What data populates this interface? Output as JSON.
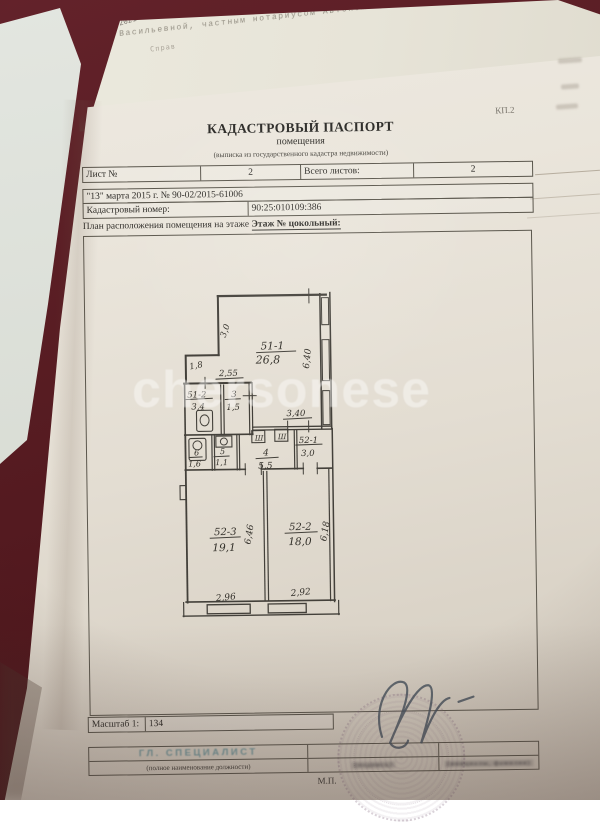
{
  "photo": {
    "watermark": "chersonese",
    "underlying": {
      "date_stamp": "23.03.2021",
      "line1": "августа 199  года».",
      "line2": "настоящий договор     удостоверен     мной,",
      "line3": "Васильевной, частным нотариусом  Автономной Республики",
      "fragment": "Справ"
    }
  },
  "document": {
    "form_code": "КП.2",
    "title": "КАДАСТРОВЫЙ ПАСПОРТ",
    "subtitle": "помещения",
    "subnote": "(выписка из государственного кадастра недвижимости)",
    "sheet": {
      "label": "Лист №",
      "value": "2",
      "total_label": "Всего листов:",
      "total_value": "2"
    },
    "date_number_line": "\"13\" марта 2015 г. № 90-02/2015-61006",
    "cadastral": {
      "label": "Кадастровый номер:",
      "value": "90:25:010109:386"
    },
    "plan_heading": {
      "prefix": "План расположения помещения на этаже",
      "floor": "Этаж № цокольный:"
    },
    "scale": {
      "label": "Масштаб 1:",
      "value": "134"
    },
    "signature_block": {
      "position": "ГЛ. СПЕЦИАЛИСТ",
      "position_note": "(полное наименование должности)",
      "sign_note": "(подпись)",
      "name_note": "(инициалы, фамилия)",
      "seal_mark": "М.П."
    }
  },
  "plan": {
    "rooms": [
      {
        "id": "51-1",
        "area": "26,8"
      },
      {
        "id": "51-2",
        "area": "3,4"
      },
      {
        "id": "3",
        "area": "1,5"
      },
      {
        "id": "4",
        "area": "5,5"
      },
      {
        "id": "5",
        "area": "1,1"
      },
      {
        "id": "6",
        "area": "1,6"
      },
      {
        "id": "52-1",
        "area": "3,0"
      },
      {
        "id": "52-2",
        "area": "18,0"
      },
      {
        "id": "52-3",
        "area": "19,1"
      }
    ],
    "dimensions": [
      "3,0",
      "6,40",
      "1,8",
      "2,55",
      "3,40",
      "6,46",
      "6,18",
      "2,96",
      "2,92"
    ],
    "wardrobe_mark": "Ш"
  }
}
